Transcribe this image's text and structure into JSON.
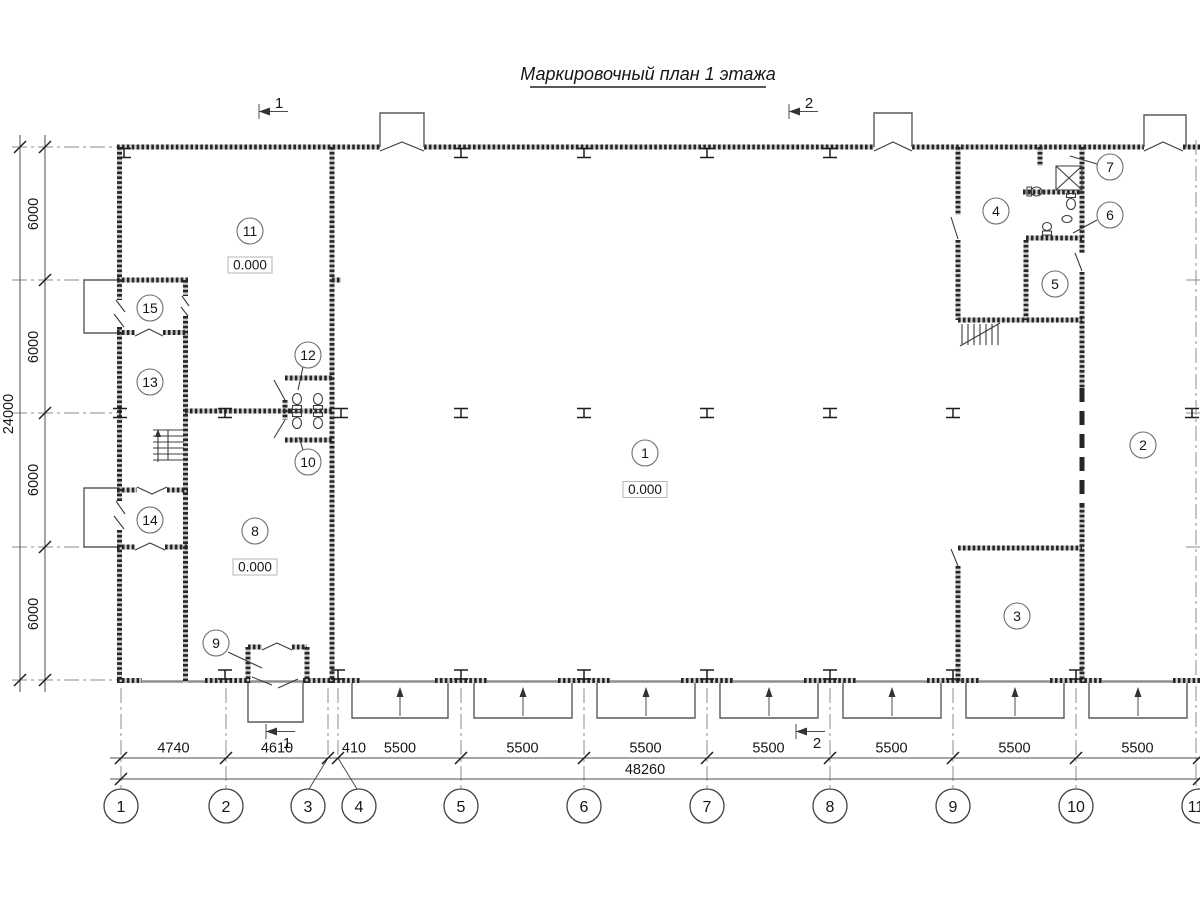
{
  "title": "Маркировочный план 1 этажа",
  "sections": {
    "s1": "1",
    "s2": "2"
  },
  "grid": [
    "1",
    "2",
    "3",
    "4",
    "5",
    "6",
    "7",
    "8",
    "9",
    "10",
    "11"
  ],
  "dims_bottom": [
    "4740",
    "4610",
    "410",
    "5500",
    "5500",
    "5500",
    "5500",
    "5500",
    "5500",
    "5500"
  ],
  "dim_total": "48260",
  "dims_left": [
    "6000",
    "6000",
    "6000",
    "6000"
  ],
  "dim_left_total": "24000",
  "rooms": [
    "1",
    "2",
    "3",
    "4",
    "5",
    "6",
    "7",
    "8",
    "9",
    "10",
    "11",
    "12",
    "13",
    "14",
    "15"
  ],
  "levels": [
    "0.000",
    "0.000",
    "0.000"
  ],
  "colors": {
    "ink": "#262626",
    "paper": "#ffffff"
  }
}
